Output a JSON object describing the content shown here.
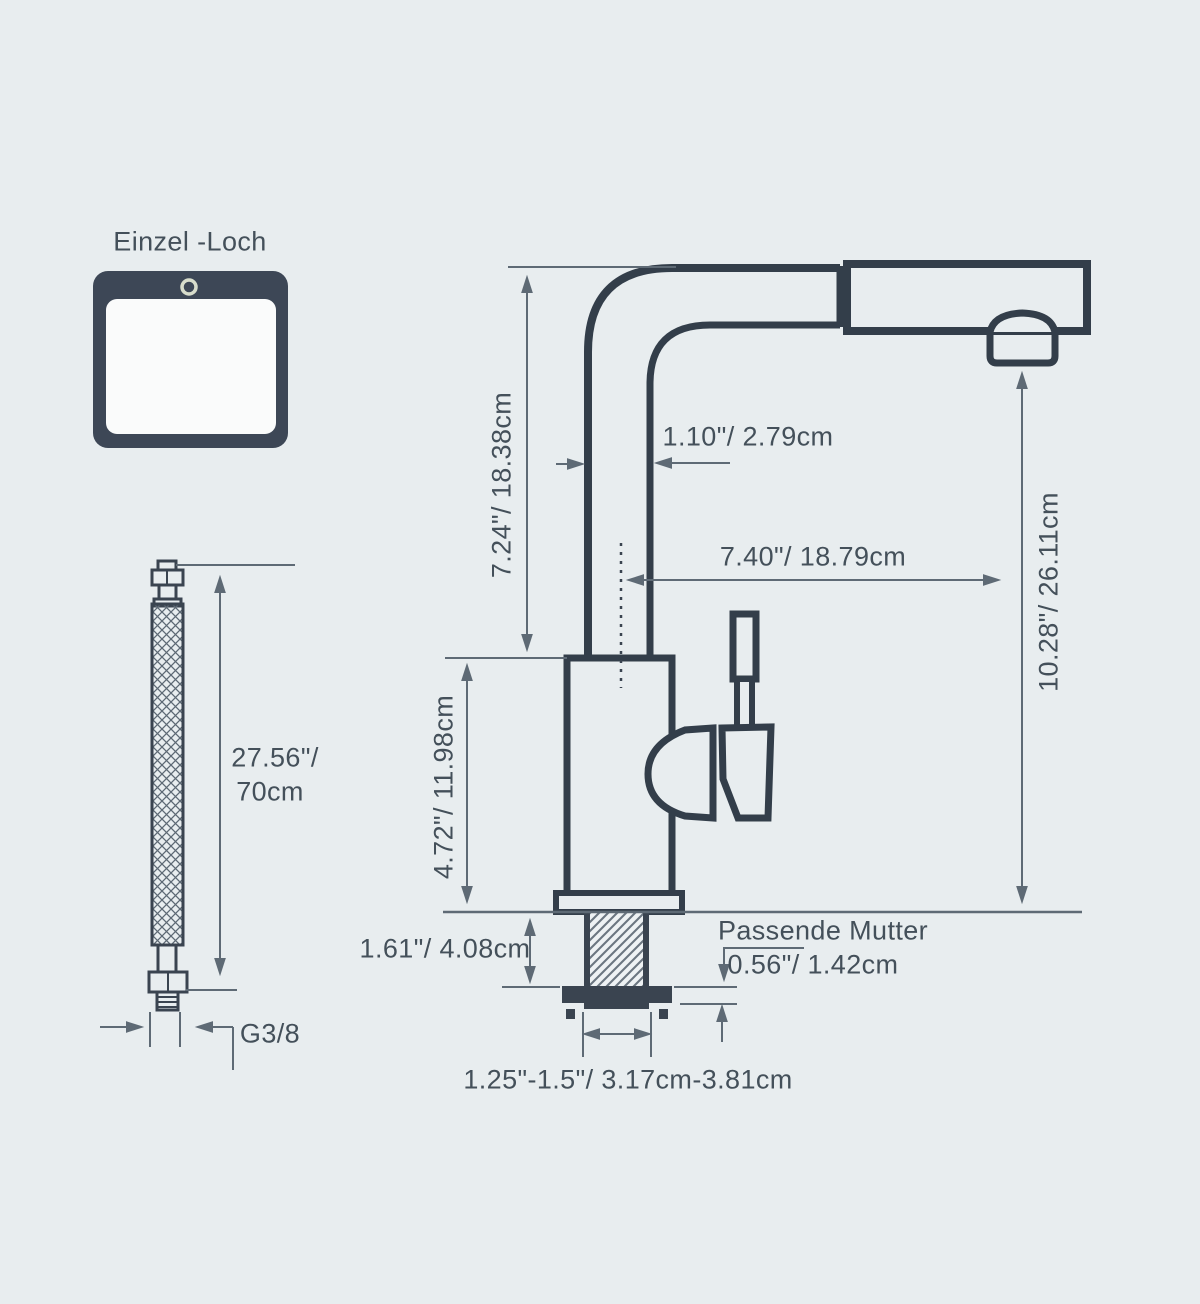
{
  "colors": {
    "background": "#e8edef",
    "outline": "#333e4a",
    "dimension_lines": "#5e6a75",
    "text": "#44505a",
    "sink_fill": "#3d4756"
  },
  "sink_hole": {
    "label": "Einzel -Loch"
  },
  "supply_hose": {
    "length_inches": "27.56\"/",
    "length_cm": "70cm",
    "connector_thread": "G3/8"
  },
  "faucet_dimensions": {
    "spout_height": "7.24\"/ 18.38cm",
    "spout_tube_width": "1.10\"/ 2.79cm",
    "spout_reach": "7.40\"/ 18.79cm",
    "overall_height": "10.28\"/ 26.11cm",
    "body_height": "4.72\"/ 11.98cm",
    "shank_length": "1.61\"/ 4.08cm",
    "fitting_nut_label": "Passende Mutter",
    "nut_height": "0.56\"/ 1.42cm",
    "hole_diameter_range": "1.25\"-1.5\"/ 3.17cm-3.81cm"
  }
}
